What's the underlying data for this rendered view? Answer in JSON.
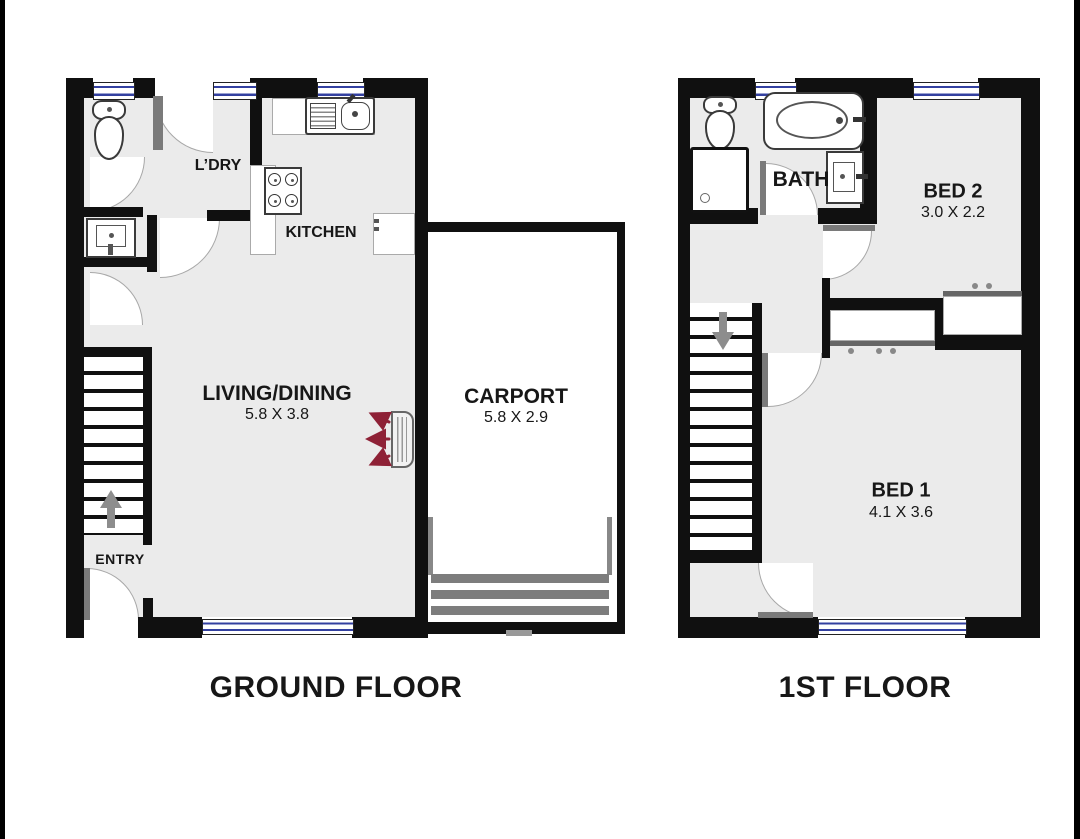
{
  "theme": {
    "wall": "#101010",
    "floor": "#ebebeb",
    "window_blue": "#3340a0",
    "door_gray": "#7a7a7a",
    "arrow_red": "#8e2136",
    "stair_arrow": "#8d8d8d",
    "page_bg": "#ffffff"
  },
  "ground_floor": {
    "title": "GROUND FLOOR",
    "labels": {
      "laundry": "L’DRY",
      "kitchen": "KITCHEN",
      "living": "LIVING/DINING",
      "living_dims": "5.8 X 3.8",
      "carport": "CARPORT",
      "carport_dims": "5.8 X 2.9",
      "entry": "ENTRY"
    }
  },
  "first_floor": {
    "title": "1ST FLOOR",
    "labels": {
      "bath": "BATH",
      "bed2": "BED 2",
      "bed2_dims": "3.0 X 2.2",
      "bed1": "BED 1",
      "bed1_dims": "4.1 X 3.6"
    }
  }
}
